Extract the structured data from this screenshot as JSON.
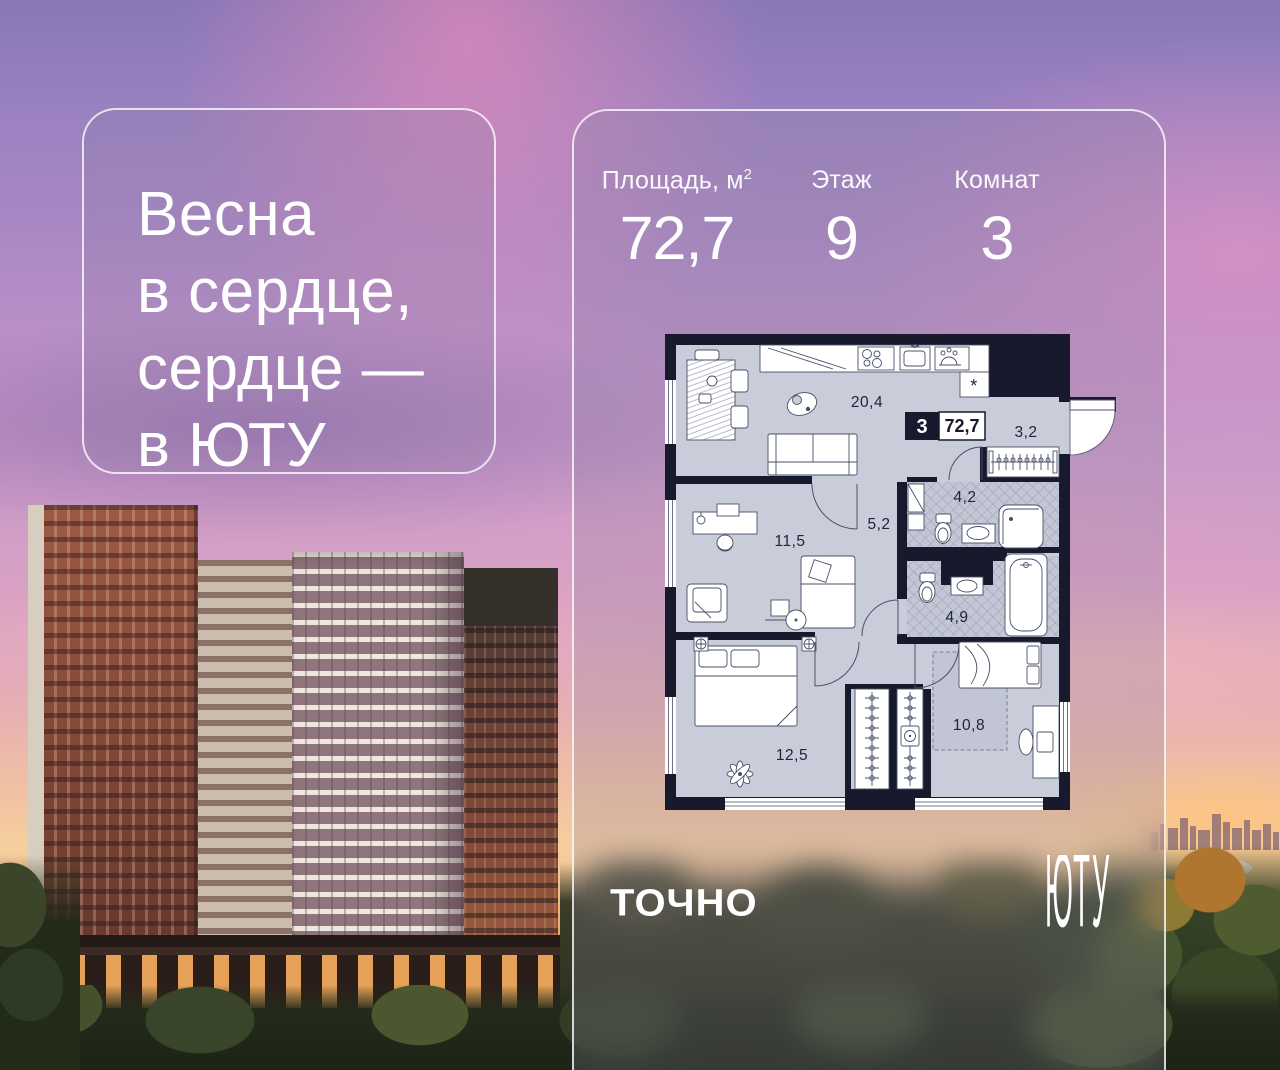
{
  "slogan": {
    "line1": "Весна",
    "line2": "в сердце,",
    "line3": "сердце —",
    "line4": "в ЮТУ"
  },
  "stats": {
    "area_label": "Площадь, м",
    "area_sup": "2",
    "area_value": "72,7",
    "floor_label": "Этаж",
    "floor_value": "9",
    "rooms_label": "Комнат",
    "rooms_value": "3"
  },
  "plan": {
    "badge_rooms": "3",
    "badge_area": "72,7",
    "area_living": "20,4",
    "area_hall": "3,2",
    "area_bath1": "4,2",
    "area_corridor": "5,2",
    "area_room": "11,5",
    "area_bath2": "4,9",
    "area_bedroom1": "12,5",
    "area_bedroom2": "10,8",
    "niche_mark": "*"
  },
  "logos": {
    "developer": "ТОЧНО",
    "project": "ЮТУ"
  },
  "colors": {
    "plan_wall": "#161a2c",
    "plan_floor": "#c9ccd9",
    "text_white": "#ffffff"
  }
}
